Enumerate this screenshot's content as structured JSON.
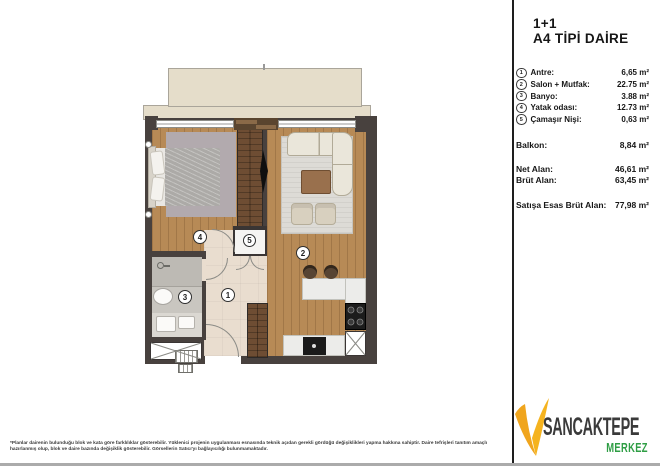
{
  "title": {
    "line1": "1+1",
    "line2": "A4 TİPİ DAİRE"
  },
  "rooms": [
    {
      "num": "1",
      "label": "Antre:",
      "area": "6,65 m²"
    },
    {
      "num": "2",
      "label": "Salon + Mutfak:",
      "area": "22.75 m²"
    },
    {
      "num": "3",
      "label": "Banyo:",
      "area": "3.88 m²"
    },
    {
      "num": "4",
      "label": "Yatak odası:",
      "area": "12.73 m²"
    },
    {
      "num": "5",
      "label": "Çamaşır Nişi:",
      "area": "0,63 m²"
    }
  ],
  "balcony_row": {
    "label": "Balkon:",
    "area": "8,84 m²"
  },
  "area_rows": [
    {
      "label": "Net Alan:",
      "area": "46,61 m²"
    },
    {
      "label": "Brüt Alan:",
      "area": "63,45 m²"
    }
  ],
  "total_row": {
    "label": "Satışa Esas Brüt Alan:",
    "area": "77,98 m²"
  },
  "disclaimer": "*Planlar dairenin bulunduğu blok ve kata göre farklılıklar gösterebilir. Yüklenici projenin uygulanması esnasında teknik açıdan gerekli gördüğü değişiklikleri yapma hakkına sahiptir. Daire tefrişleri tanıtım amaçlı hazırlanmış olup, blok ve daire bazında değişiklik gösterebilir. Görsellerin Satıcı'yı bağlayıcılığı bulunmamaktadır.",
  "logo": {
    "name": "SANCAKTEPE",
    "sub": "MERKEZ",
    "v_color": "#f0a51d",
    "name_color": "#3a3a3a",
    "sub_color": "#2f9e45"
  },
  "plan_colors": {
    "wall": "#48413e",
    "wood_floor": "#b78a56",
    "hall_floor": "#e9ddcf",
    "bath_floor": "#c9c6c0",
    "balcony_floor": "#e5ddca"
  }
}
